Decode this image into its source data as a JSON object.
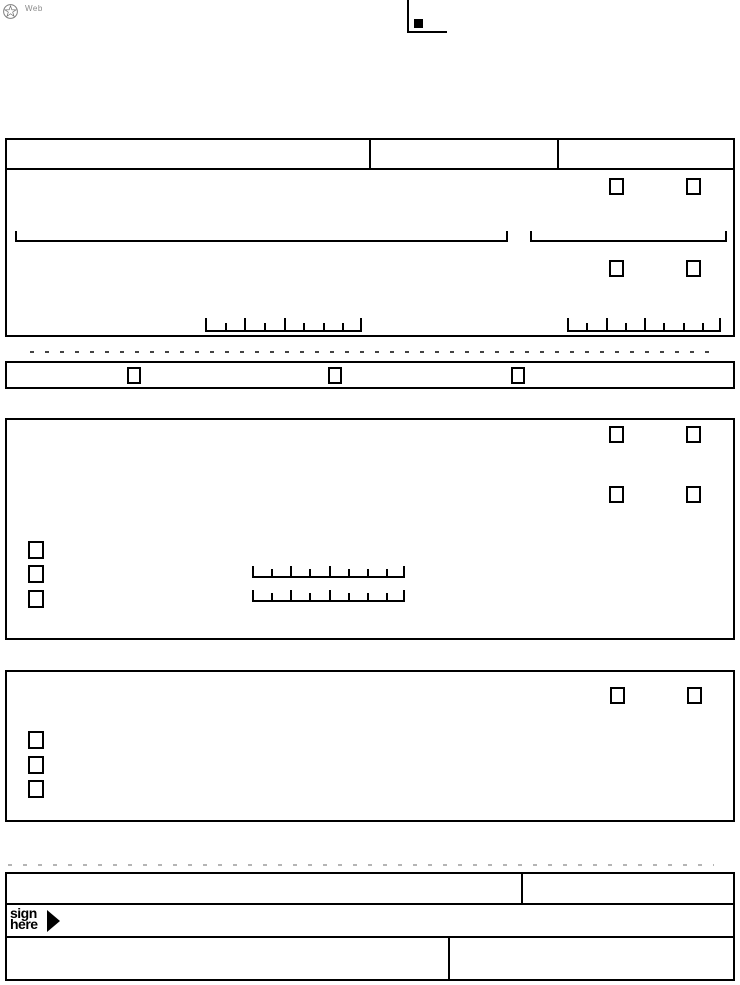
{
  "page": {
    "width": 740,
    "height": 985,
    "background": "#ffffff",
    "line_color": "#000000",
    "dash_color": "#444444",
    "light_dash_color": "#b5b5b5",
    "logo_stroke_color": "#808080"
  },
  "branding": {
    "logo_icon": "circled-star-seal",
    "web_mark": "Web"
  },
  "registration_mark": {
    "icon": "corner-crop-mark",
    "square_icon": "filled-square",
    "square_color": "#000000"
  },
  "header_table": {
    "columns": 3
  },
  "form": {
    "comb": {
      "cells": 8,
      "group_dividers": [
        0,
        2,
        4,
        8
      ]
    },
    "section1": {
      "checkbox_pairs": 2,
      "write_in_lines": 2,
      "date_combs": 2
    },
    "option_band": {
      "checkboxes": 3
    },
    "section2": {
      "checkbox_pairs": 2,
      "option_checkboxes": 3,
      "date_combs": 2
    },
    "section3": {
      "checkbox_pairs": 1,
      "option_checkboxes": 3
    }
  },
  "signature": {
    "line1": "sign",
    "line2": "here",
    "arrow_icon": "right-triangle-arrow"
  }
}
